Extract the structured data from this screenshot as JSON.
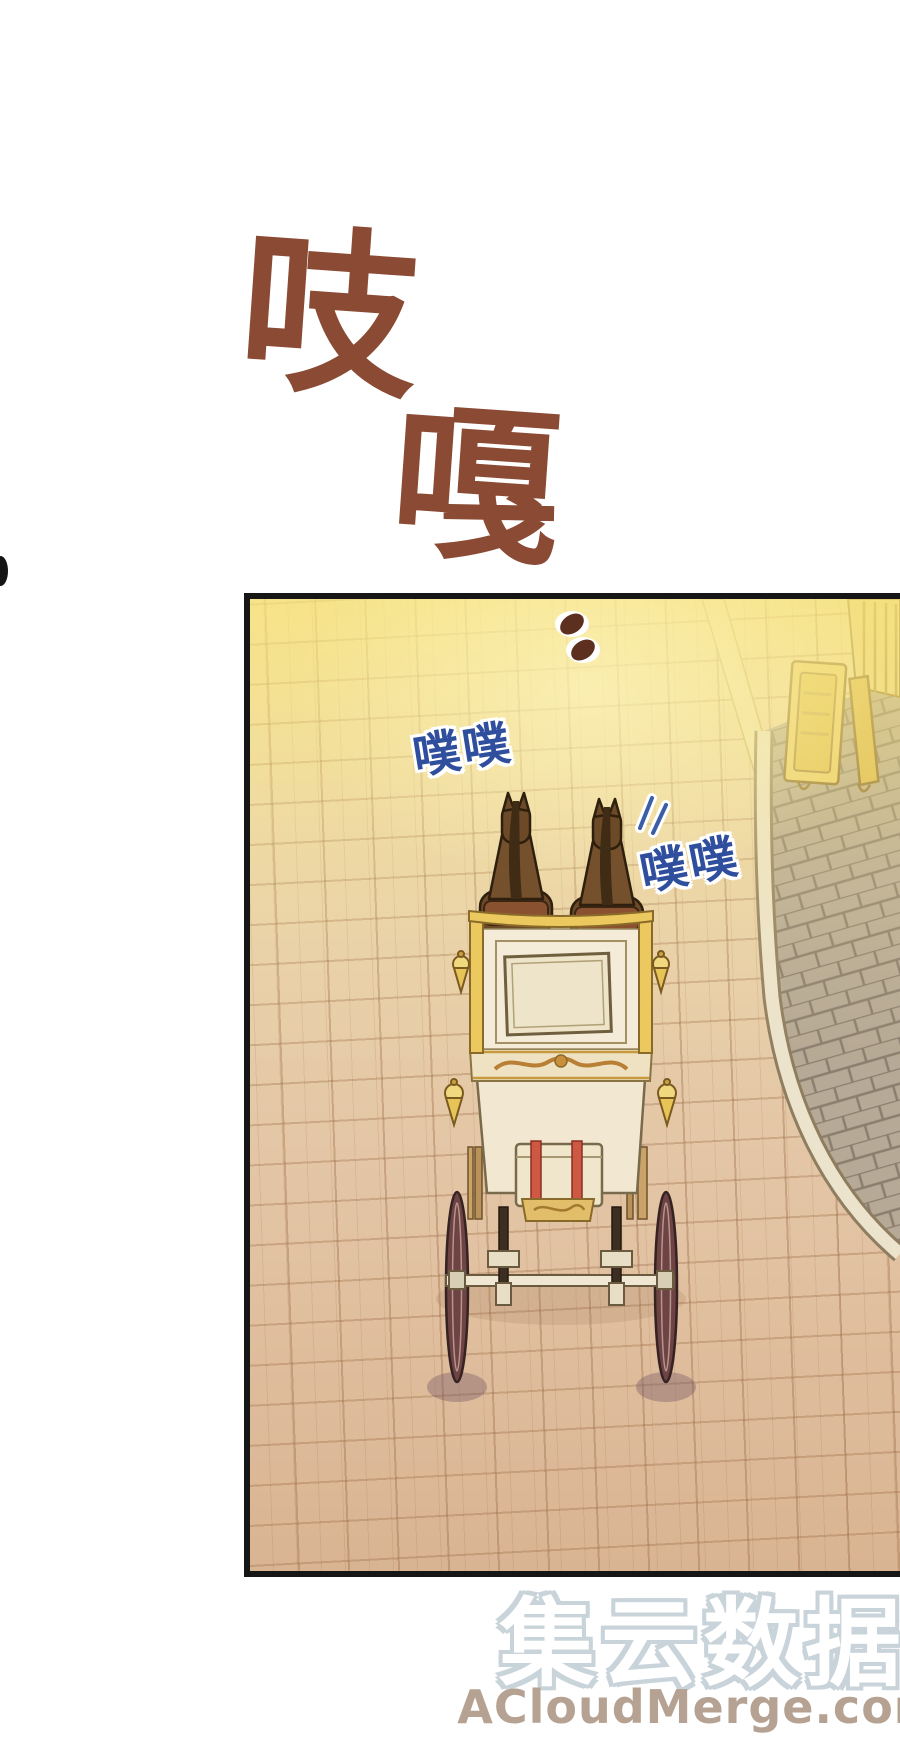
{
  "sfx": {
    "creak_char_1": "吱",
    "creak_char_2": "嘎",
    "creak_color": "#8a4a33",
    "clop_text_1": "噗噗",
    "clop_text_2": "噗噗",
    "clop_color": "#2f4f9e"
  },
  "panel": {
    "border_color": "#161616",
    "scene": "horse-drawn carriage seen from behind on a sunlit cobblestone street"
  },
  "watermark": {
    "cn": "集云数据",
    "en": "ACloudMerge.com",
    "cn_fill": "#ffffff",
    "cn_outline": "#c9d3da",
    "en_color": "#b5a292"
  }
}
